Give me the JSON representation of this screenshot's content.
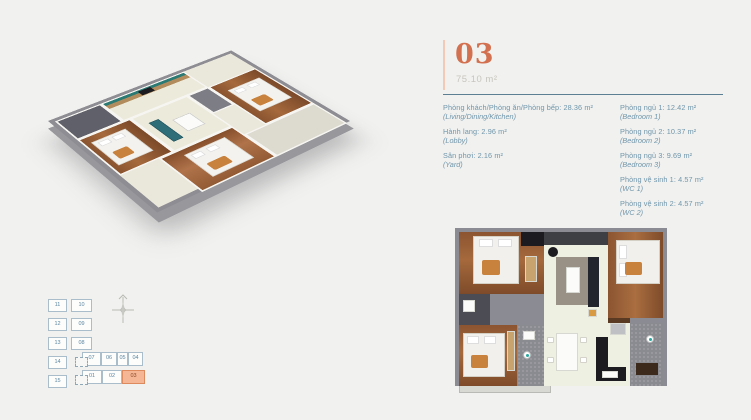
{
  "colors": {
    "accent": "#d2704f",
    "accent_light": "#f5b696",
    "text": "#6f96ab",
    "divider": "#5d7f93",
    "background": "#f1f1ef"
  },
  "header": {
    "unit_number": "03",
    "area": "75.10 m²"
  },
  "room_details": {
    "left": [
      {
        "vi": "Phòng khách/Phòng ăn/Phòng bếp: 28.36 m²",
        "en": "(Living/Dining/Kitchen)"
      },
      {
        "vi": "Hành lang: 2.96 m²",
        "en": "(Lobby)"
      },
      {
        "vi": "Sân phơi: 2.16 m²",
        "en": "(Yard)"
      }
    ],
    "right": [
      {
        "vi": "Phòng ngủ 1: 12.42 m²",
        "en": "(Bedroom 1)"
      },
      {
        "vi": "Phòng ngủ 2: 10.37 m²",
        "en": "(Bedroom 2)"
      },
      {
        "vi": "Phòng ngủ 3: 9.69 m²",
        "en": "(Bedroom 3)"
      },
      {
        "vi": "Phòng vệ sinh 1: 4.57 m²",
        "en": "(WC 1)"
      },
      {
        "vi": "Phòng vệ sinh 2: 4.57 m²",
        "en": "(WC 2)"
      }
    ]
  },
  "unit_locator": {
    "highlighted_unit": "03",
    "cells": [
      {
        "label": "11",
        "x": 4,
        "y": 3,
        "w": 19,
        "h": 13
      },
      {
        "label": "12",
        "x": 4,
        "y": 22,
        "w": 19,
        "h": 13
      },
      {
        "label": "13",
        "x": 4,
        "y": 41,
        "w": 19,
        "h": 13
      },
      {
        "label": "14",
        "x": 4,
        "y": 60,
        "w": 19,
        "h": 13
      },
      {
        "label": "15",
        "x": 4,
        "y": 79,
        "w": 19,
        "h": 13
      },
      {
        "label": "10",
        "x": 27,
        "y": 3,
        "w": 21,
        "h": 13
      },
      {
        "label": "09",
        "x": 27,
        "y": 22,
        "w": 21,
        "h": 13
      },
      {
        "label": "08",
        "x": 27,
        "y": 41,
        "w": 21,
        "h": 13
      },
      {
        "label": "07",
        "x": 38,
        "y": 56,
        "w": 19,
        "h": 14
      },
      {
        "label": "06",
        "x": 57,
        "y": 56,
        "w": 16,
        "h": 14
      },
      {
        "label": "05",
        "x": 73,
        "y": 56,
        "w": 11,
        "h": 14
      },
      {
        "label": "04",
        "x": 84,
        "y": 56,
        "w": 15,
        "h": 14
      },
      {
        "label": "01",
        "x": 38,
        "y": 74,
        "w": 20,
        "h": 14
      },
      {
        "label": "02",
        "x": 58,
        "y": 74,
        "w": 20,
        "h": 14
      },
      {
        "label": "03",
        "x": 78,
        "y": 74,
        "w": 23,
        "h": 14,
        "highlight": true
      }
    ],
    "elevators": [
      {
        "x": 31,
        "y": 61,
        "w": 13,
        "h": 10
      },
      {
        "x": 31,
        "y": 79,
        "w": 13,
        "h": 10
      }
    ]
  }
}
